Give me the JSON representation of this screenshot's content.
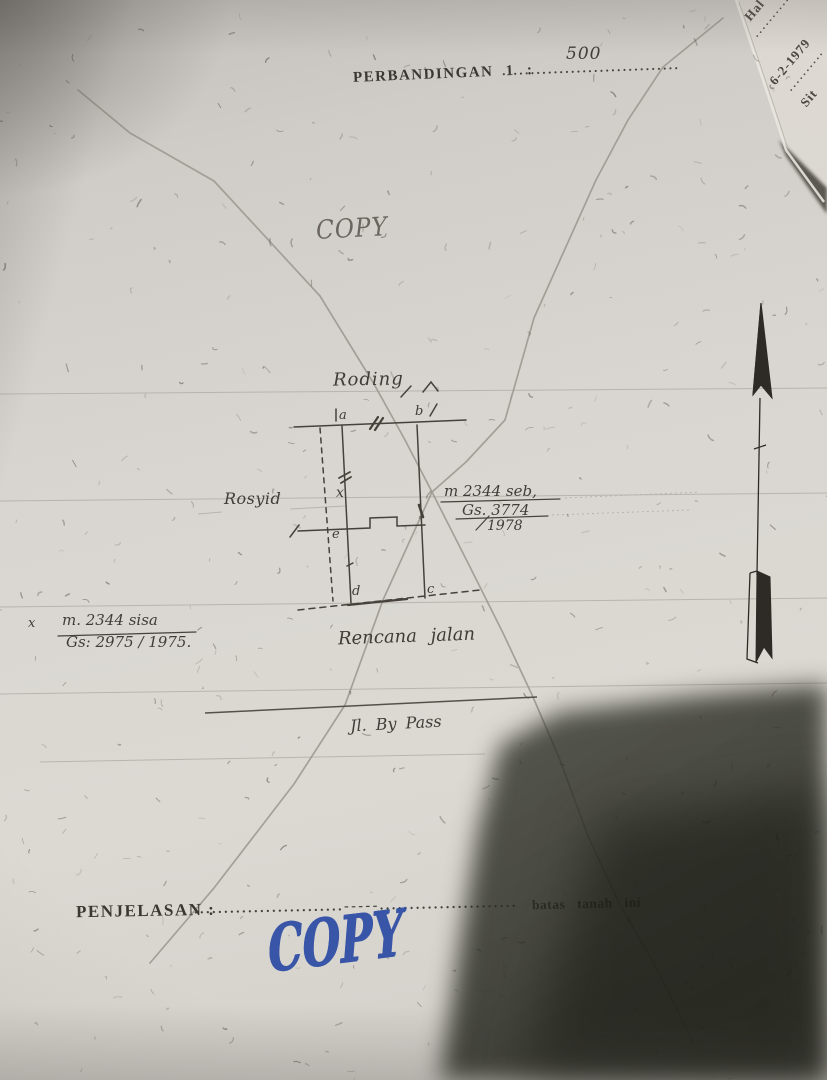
{
  "colors": {
    "paper": "#d8d5d0",
    "ink": "#45423c",
    "pencil": "#9b968e",
    "marker_blue": "#2c4ba4",
    "shadow": "#35382c"
  },
  "header": {
    "scale_label": "PERBANDINGAN 1 :",
    "scale_dots": "...............................",
    "scale_value": "500"
  },
  "stamps": {
    "pencil_copy": "COPY",
    "blue_copy": "COPY"
  },
  "corner_page": {
    "hal": "Hal ———",
    "dots1": "··········",
    "date": "6-2-1979",
    "dots2": "··········",
    "sit": "Sit"
  },
  "sketch": {
    "road_top_label": "Roding",
    "owner_label": "Rosyid",
    "parcel_note": {
      "line1": "m 2344 seb,",
      "line2": "Gs. 3774",
      "line3": "1978"
    },
    "remainder_note": {
      "marker": "x",
      "line1": "m. 2344 sisa",
      "line2": "Gs: 2975 / 1975."
    },
    "planned_road_label": "Rencana jalan",
    "bypass_road_label": "Jl. By Pass",
    "points": {
      "a": "a",
      "b": "b",
      "c": "c",
      "d": "d",
      "e": "e",
      "x": "x"
    }
  },
  "footer": {
    "label": "PENJELASAN :",
    "dots": ".........................-----.......................",
    "batas": "batas tanah ini"
  }
}
